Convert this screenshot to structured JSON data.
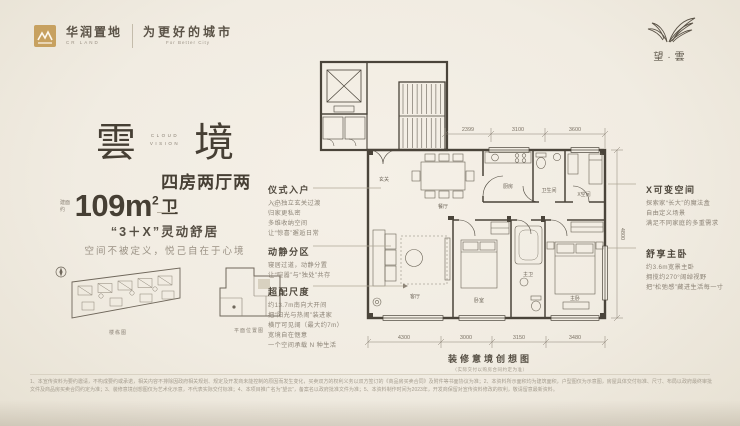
{
  "brand": {
    "logo_cn": "华润置地",
    "logo_en": "CR LAND",
    "slogan_cn": "为更好的城市",
    "slogan_en": "For Better City",
    "project_name": "望·雲"
  },
  "hero": {
    "title_char1": "雲",
    "title_char2": "境",
    "title_en1": "CLOUD",
    "title_en2": "VISION",
    "area_prefix": "建面约",
    "area_value": "109m",
    "area_sup": "2",
    "area_desc": "四房两厅两卫",
    "area_note": "（注）",
    "tagline": "“3＋X”灵动舒居",
    "subtitle": "空间不被定义，悦己自在于心境",
    "diagram_site_caption": "楼栋图",
    "diagram_key_caption": "平面位置图"
  },
  "annotations": {
    "left": [
      {
        "heading": "仪式入户",
        "lines": [
          "入户独立玄关过渡",
          "归家更私密",
          "多维收纳空间",
          "让“惊喜”邂逅日常"
        ]
      },
      {
        "heading": "动静分区",
        "lines": [
          "寝居过道，动静分置",
          "让“喧嚣”与“独处”共存"
        ]
      },
      {
        "heading": "超配尺度",
        "lines": [
          "约13.7m南向大开间",
          "把“阳光与热闹”装进家",
          "横厅可见阔（最大约7m）",
          "宽境自在惬意",
          "一个空间承载 N 种生活"
        ]
      }
    ],
    "right": [
      {
        "heading": "X可变空间",
        "lines": [
          "探索家“长大”的魔法盒",
          "自由定义场景",
          "满足不同家庭的多重需求"
        ]
      },
      {
        "heading": "舒享主卧",
        "lines": [
          "约3.6m宽景主卧",
          "拥揽约270°阔绰视野",
          "把“松弛感”藏进生活每一寸"
        ]
      }
    ]
  },
  "floor_plan": {
    "caption": "装修意境创想图",
    "caption_note": "（实际交付以购房合同约定为准）",
    "rooms": {
      "foyer": "玄关",
      "dining": "餐厅",
      "kitchen": "厨房",
      "bath1": "卫生间",
      "xroom": "X空间",
      "living": "客厅",
      "bedroom": "卧室",
      "bath2": "主卫",
      "master": "主卧"
    },
    "dims_top": [
      "2399",
      "3100",
      "3600"
    ],
    "dims_bottom": [
      "4300",
      "3000",
      "3150",
      "3480"
    ],
    "dim_right": "4800"
  },
  "footer": {
    "disclaimer": "1、本宣传资料为要约邀请，不构成要约或承诺，相关内容不排除因政府相关规划、规定及开发商未能控制的原因而发生变化，买卖双方的权利义务以双方签订的《商品房买卖合同》及附件等书面协议为准；2、本资料所示面积均为建筑面积，户型图仅为示意图，房屋具体交付标准、尺寸、布局以政府最终审批文件及商品房买卖合同约定为准；3、装修意境创想图仅为艺术化示意，不代表实际交付标准；4、本项目推广名为“望云”，备案名以政府批准文件为准；5、本资料制作时间为2023年，开发商保留对宣传资料修改的权利，敬请留意最新资料。"
  },
  "colors": {
    "background": "#f1ece2",
    "ink": "#4a443a",
    "gold": "#c7a160",
    "muted": "#8d8477"
  }
}
